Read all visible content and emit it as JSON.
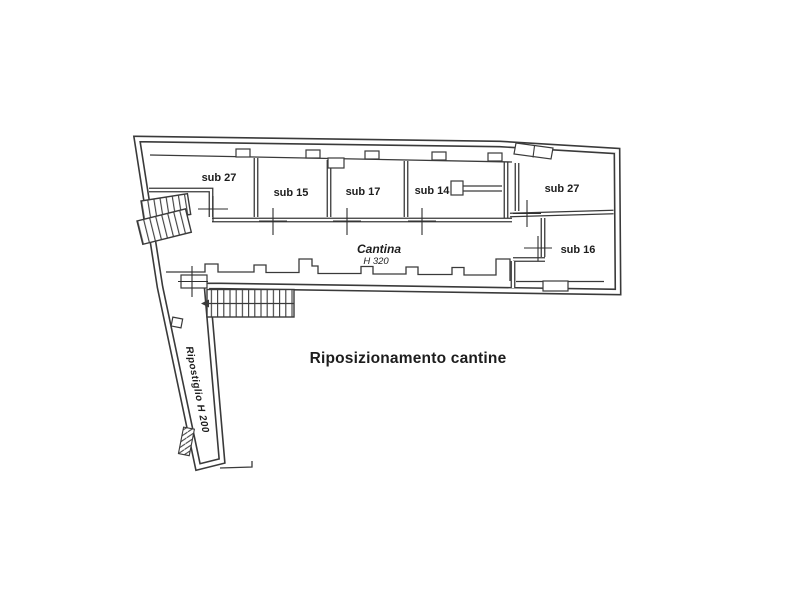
{
  "plan": {
    "caption": "Riposizionamento  cantine",
    "rooms": [
      {
        "id": "sub27-left",
        "label": "sub 27"
      },
      {
        "id": "sub15",
        "label": "sub 15"
      },
      {
        "id": "sub17",
        "label": "sub 17"
      },
      {
        "id": "sub14",
        "label": "sub 14"
      },
      {
        "id": "sub27-right",
        "label": "sub 27"
      },
      {
        "id": "sub16",
        "label": "sub 16"
      }
    ],
    "cantina": {
      "name": "Cantina",
      "height": "H 320"
    },
    "corridor": {
      "label": "Ripostiglio H 200"
    }
  },
  "colors": {
    "ink": "#3a3a3a",
    "text": "#1d1d1d",
    "background": "#ffffff"
  }
}
